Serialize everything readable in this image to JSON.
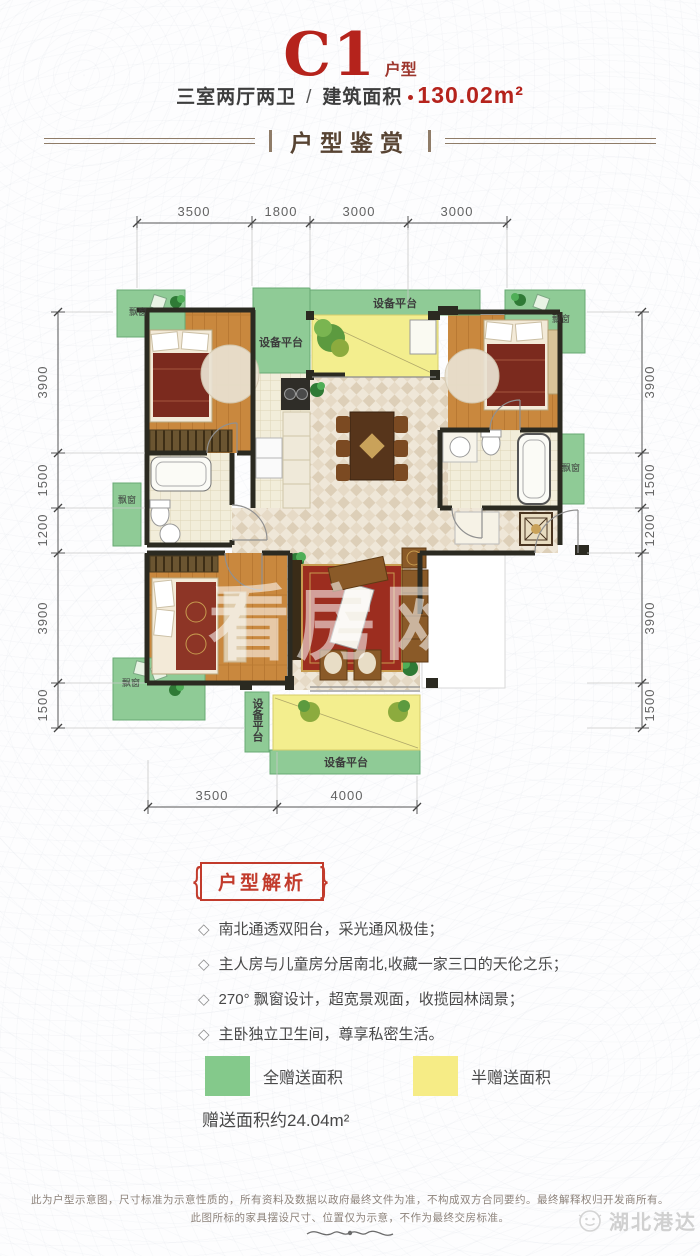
{
  "header": {
    "title": "C1",
    "title_suffix": "户型",
    "layout_type": "三室两厅两卫",
    "separator": "/",
    "area_label": "建筑面积",
    "area_value": "130.02m²",
    "section_banner": "户型鉴赏"
  },
  "plan": {
    "dims_top": [
      "3500",
      "1800",
      "3000",
      "3000"
    ],
    "dims_left": [
      "3900",
      "1500",
      "1200",
      "3900",
      "1500"
    ],
    "dims_right": [
      "3900",
      "1500",
      "1200",
      "3900",
      "1500"
    ],
    "dims_bottom": [
      "3500",
      "4000"
    ],
    "labels": {
      "equip_platform": "设备平台",
      "bay_window": "飘窗"
    },
    "watermark": "看房网"
  },
  "analysis": {
    "section_title": "户型解析",
    "brace_left": "{",
    "brace_right": "}",
    "bullet_icon": "◇",
    "bullets": [
      "南北通透双阳台，采光通风极佳；",
      "主人房与儿童房分居南北,收藏一家三口的天伦之乐；",
      "270° 飘窗设计，超宽景观面，收揽园林阔景；",
      "主卧独立卫生间，尊享私密生活。"
    ]
  },
  "legend": {
    "items": [
      {
        "label": "全赠送面积",
        "color": "#84c98b"
      },
      {
        "label": "半赠送面积",
        "color": "#f6ec86"
      }
    ],
    "note": "赠送面积约24.04m²"
  },
  "footer": {
    "line1": "此为户型示意图，尺寸标准为示意性质的，所有资料及数据以政府最终文件为准，不构成双方合同要约。最终解释权归开发商所有。",
    "line2": "此图所标的家具摆设尺寸、位置仅为示意，不作为最终交房标准。",
    "brand": "湖北港达"
  },
  "colors": {
    "accent_red": "#b5231c",
    "banner_brown": "#584433",
    "full_gift_green": "#84c98b",
    "half_gift_yellow": "#f6ec86"
  }
}
